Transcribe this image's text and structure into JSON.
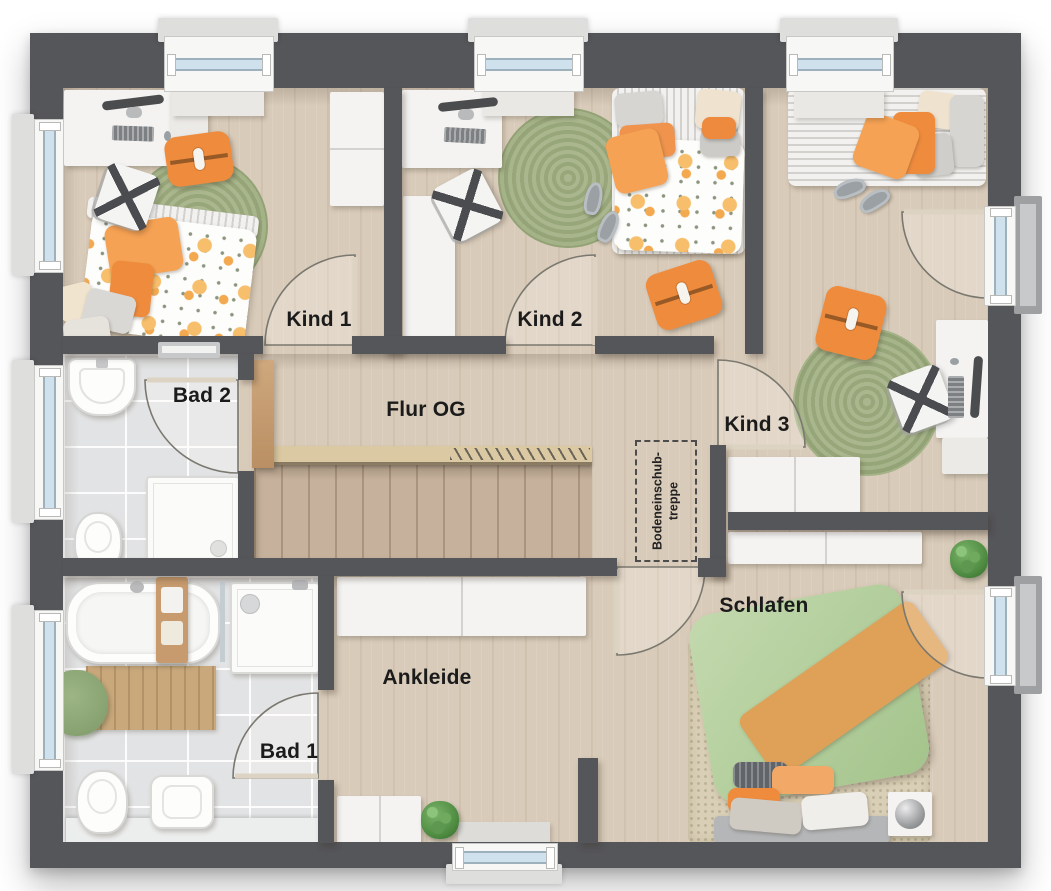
{
  "rooms": {
    "kind1": {
      "label": "Kind 1"
    },
    "kind2": {
      "label": "Kind 2"
    },
    "kind3": {
      "label": "Kind 3"
    },
    "flur": {
      "label": "Flur OG"
    },
    "bad1": {
      "label": "Bad 1"
    },
    "bad2": {
      "label": "Bad 2"
    },
    "ankleide": {
      "label": "Ankleide"
    },
    "schlafen": {
      "label": "Schlafen"
    }
  },
  "annotations": {
    "attic_stairs": {
      "line1": "Bodeneinschub-",
      "line2": "treppe"
    }
  },
  "colors": {
    "wall": "#55565a",
    "wood_floor": "#d9cbb9",
    "stair_wood": "#c6b29c",
    "tile_floor": "#e2e3e4",
    "accent_orange": "#ef8b3d",
    "accent_green": "#a3b184",
    "bed_green": "#b8d1a6",
    "window_glass": "#cfe1ec"
  }
}
